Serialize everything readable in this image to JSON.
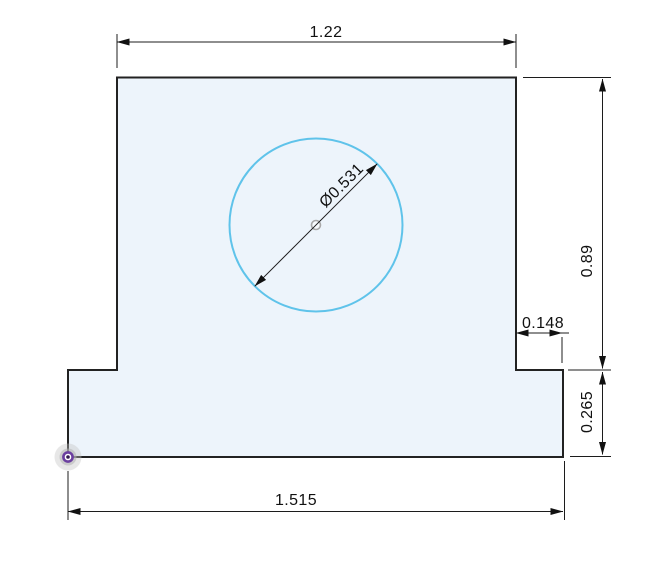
{
  "drawing": {
    "dimensions": {
      "top_width": "1.22",
      "right_height": "0.89",
      "step_width": "0.148",
      "base_height": "0.265",
      "base_width": "1.515",
      "hole_diameter": "Ø0.531"
    },
    "colors": {
      "region_fill": "#edf4fb",
      "profile_stroke": "#222222",
      "sketch_entity_blue": "#5fc3ea",
      "dimension_ink": "#111111",
      "origin_purple": "#6b3fa0"
    }
  }
}
